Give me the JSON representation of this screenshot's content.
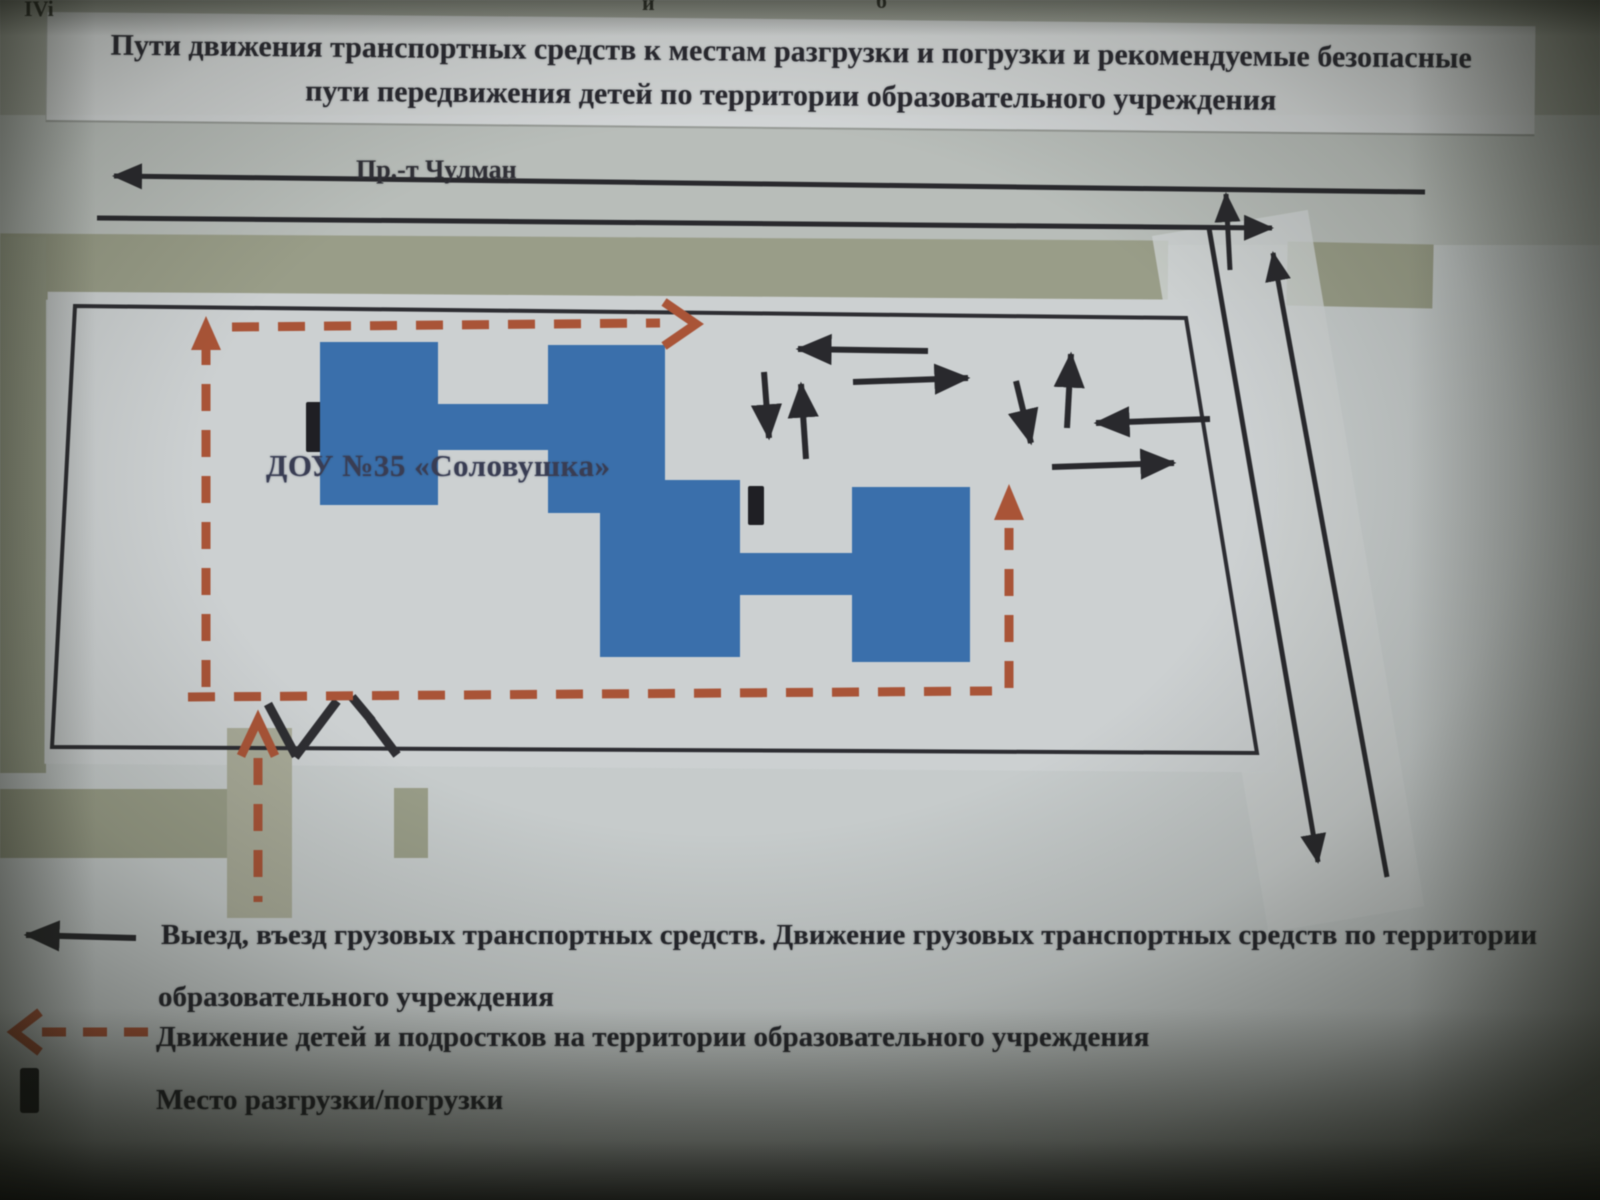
{
  "photo": {
    "edge_fragments": {
      "left": "IVi",
      "middle": "й",
      "right": "б"
    }
  },
  "title": {
    "line1": "Пути движения транспортных средств к местам разгрузки и погрузки и рекомендуемые безопасные",
    "line2": "пути передвижения детей по территории образовательного учреждения"
  },
  "map": {
    "street_label": "Пр.-т Чулман",
    "building_label": "ДОУ №35 «Соловушка»"
  },
  "legend": {
    "items": [
      {
        "symbol": "black-arrow",
        "line1": "Выезд, въезд грузовых транспортных средств. Движение грузовых транспортных средств по территории",
        "line2": "образовательного учреждения"
      },
      {
        "symbol": "red-dashed-arrow",
        "text": "Движение детей и подростков на территории образовательного учреждения"
      },
      {
        "symbol": "black-rectangle",
        "text": "Место разгрузки/погрузки"
      }
    ]
  },
  "colors": {
    "building_blue": "#3170b6",
    "route_red": "#b4502f",
    "line_black": "#26262b",
    "paper": "#ced3d4",
    "olive": "#9a9e86"
  }
}
